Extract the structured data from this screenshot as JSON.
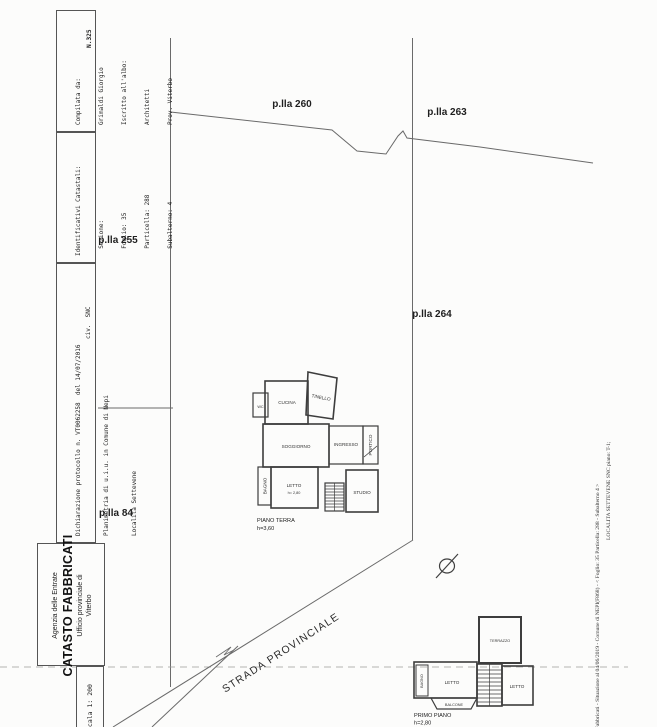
{
  "document": {
    "registration_number": "N.325",
    "compiler": {
      "lines": [
        "Compilata da:",
        "Grimaldi Giorgio",
        "Iscritto all'albo:",
        "Architetti",
        "Prov. Viterbo"
      ]
    },
    "cadastral_ids": {
      "lines": [
        "Identificativi Catastali:",
        "  Sezione:",
        "  Foglio: 35",
        "  Particella: 288",
        "  Subalterno: 4"
      ]
    },
    "declaration": {
      "lines": [
        "Dichiarazione protocollo n. VT0062258  del 14/07/2016",
        "Planimetria di u.i.u. in Comune di Nepi",
        "Località Settevene"
      ],
      "civic": "civ.  SNC"
    },
    "agency": {
      "line1": "Agenzia delle Entrate",
      "line2": "CATASTO FABBRICATI",
      "line3": "Ufficio provinciale di",
      "line4": "Viterbo"
    },
    "scale": "Scala 1: 200",
    "footer": {
      "line1": "di Fabbricati - Situazione al 04/06/2019 - Comune di NEPI(F868) - < Foglio: 35 Particella: 288 - Subalterno 4 >",
      "line2": "LOCALITA SETTEVENE SNC piano: T-1;"
    }
  },
  "map": {
    "parcels": [
      {
        "label": "p.lla 260"
      },
      {
        "label": "p.lla 263"
      },
      {
        "label": "p.lla 255"
      },
      {
        "label": "p.lla 264"
      },
      {
        "label": "p.lla 84"
      }
    ],
    "road_label": "STRADA PROVINCIALE"
  },
  "ground_floor": {
    "caption": "PIANO TERRA",
    "height_note": "h=3,60",
    "rooms": {
      "cucina": "CUCINA",
      "tinello": "TINELLO",
      "wc": "WC",
      "soggiorno": "SOGGIORNO",
      "ingresso": "INGRESSO",
      "portico": "PORTICO",
      "bagno": "BAGNO",
      "letto": "LETTO",
      "letto_height": "h= 2,80",
      "studio": "STUDIO"
    }
  },
  "first_floor": {
    "caption": "PRIMO PIANO",
    "height_note": "h=2,80",
    "rooms": {
      "terrazzo": "TERRAZZO",
      "bagno": "BAGNO",
      "letto_left": "LETTO",
      "letto_right": "LETTO",
      "balcone": "BALCONE"
    }
  }
}
